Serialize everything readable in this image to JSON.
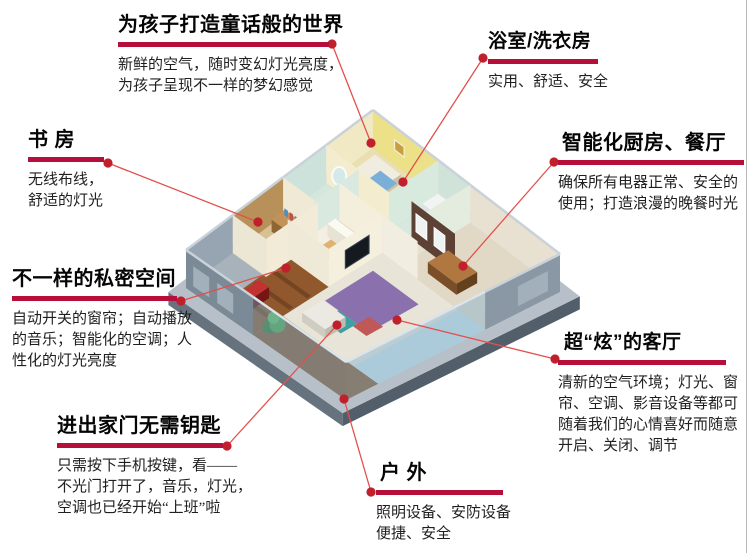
{
  "page": {
    "background": "#ffffff"
  },
  "colors": {
    "underline_bar": "#b6103a",
    "leader_dot": "#c11f2b",
    "leader_line": "#e2504c",
    "title_text": "#050505",
    "body_text": "#1f1f1f"
  },
  "callouts": [
    {
      "id": "children-room",
      "title": "为孩子打造童话般的世界",
      "body": "新鲜的空气，随时变幻灯光亮度，\n为孩子呈现不一样的梦幻感觉"
    },
    {
      "id": "bathroom-laundry",
      "title": "浴室/洗衣房",
      "body": "实用、舒适、安全"
    },
    {
      "id": "study-room",
      "title": "书 房",
      "body": "无线布线，\n舒适的灯光"
    },
    {
      "id": "smart-kitchen-dining",
      "title": "智能化厨房、餐厅",
      "body": "确保所有电器正常、安全的\n使用；打造浪漫的晚餐时光"
    },
    {
      "id": "private-space",
      "title": "不一样的私密空间",
      "body": "自动开关的窗帘；自动播放\n的音乐；智能化的空调；人\n性化的灯光亮度"
    },
    {
      "id": "keyless-entry",
      "title": "进出家门无需钥匙",
      "body": "只需按下手机按键，看——\n不光门打开了，音乐，灯光，\n空调也已经开始“上班”啦"
    },
    {
      "id": "cool-living-room",
      "title": "超“炫”的客厅",
      "body": "清新的空气环境；灯光、窗\n帘、空调、影音设备等都可\n随着我们的心情喜好而随意\n开启、关闭、调节"
    },
    {
      "id": "outdoor",
      "title": "户 外",
      "body": "照明设备、安防设备\n便捷、安全"
    }
  ]
}
